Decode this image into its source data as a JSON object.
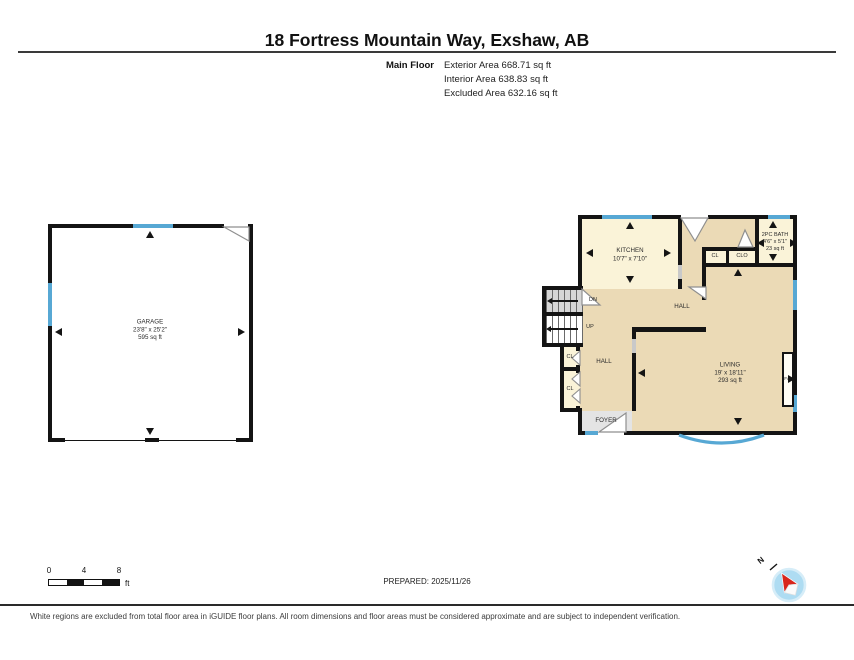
{
  "header": {
    "title": "18 Fortress Mountain Way, Exshaw, AB",
    "floor_label": "Main Floor",
    "areas": [
      "Exterior Area 668.71 sq ft",
      "Interior Area 638.83 sq ft",
      "Excluded Area 632.16 sq ft"
    ]
  },
  "garage": {
    "name": "GARAGE",
    "dims": "23'8\" x 25'2\"",
    "area": "595 sq ft"
  },
  "rooms": {
    "kitchen": {
      "name": "KITCHEN",
      "dims": "10'7\" x 7'10\""
    },
    "bath": {
      "name": "2PC BATH",
      "dims": "4'6\" x 5'1\"",
      "area": "23 sq ft"
    },
    "living": {
      "name": "LIVING",
      "dims": "19' x 18'11\"",
      "area": "293 sq ft"
    },
    "hall_upper": "HALL",
    "hall_lower": "HALL",
    "foyer": "FOYER",
    "closet_upper_1": "CL",
    "closet_upper_2": "CLO",
    "closet_lower_1": "CL",
    "closet_lower_2": "CL",
    "stair_down": "DN",
    "stair_up": "UP",
    "fireplace": "F/P"
  },
  "scale_bar": {
    "ticks": [
      "0",
      "4",
      "8"
    ],
    "unit": "ft"
  },
  "prepared_label": "PREPARED: 2025/11/26",
  "compass": {
    "north_label": "N"
  },
  "disclaimer": "White regions are excluded from total floor area in iGUIDE floor plans. All room dimensions and floor areas must be considered approximate and are subject to independent verification.",
  "colors": {
    "included_beige": "#ebdab6",
    "room_cream": "#faf3d8",
    "window_blue": "#57a8d4",
    "wall_black": "#141414",
    "excluded_white": "#ffffff",
    "foyer_gray": "#e4e4e4",
    "stair_gray": "#d6d6d6",
    "compass_red": "#d8261c",
    "compass_fill": "#aedcf2"
  }
}
